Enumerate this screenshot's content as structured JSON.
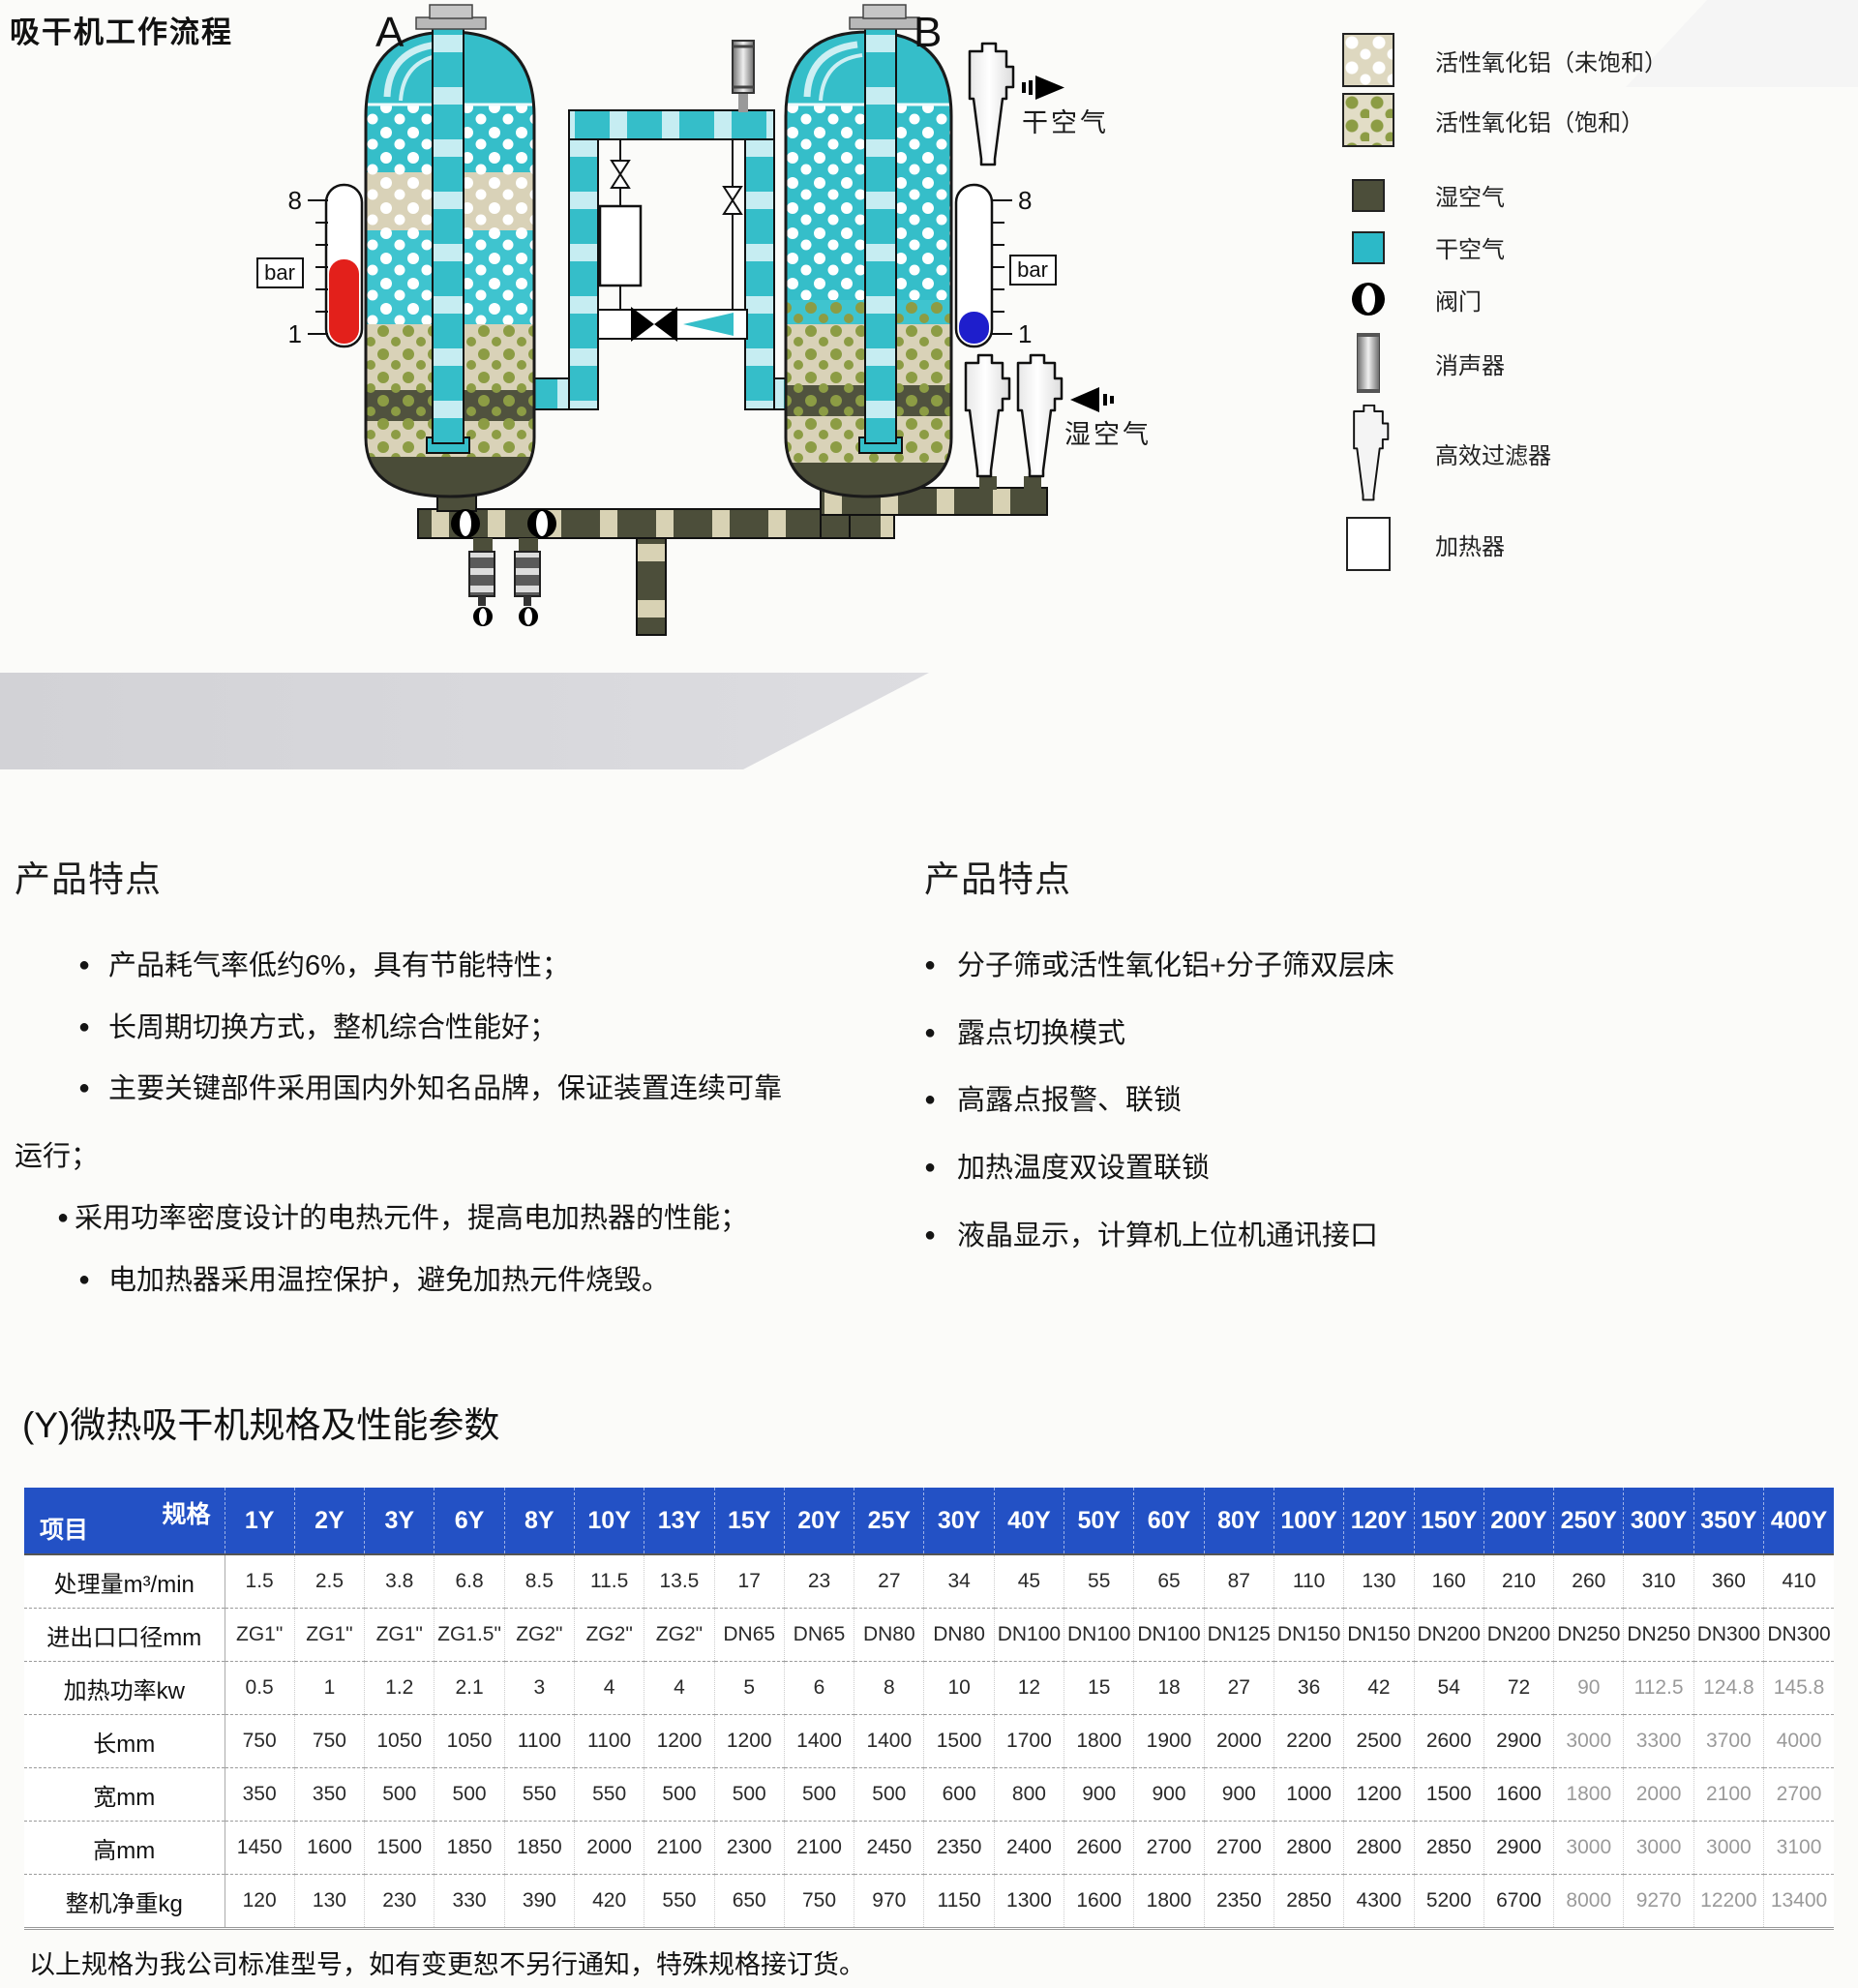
{
  "page_title": "吸干机工作流程",
  "diagram": {
    "vessel_a": "A",
    "vessel_b": "B",
    "gauge_max": "8",
    "gauge_min": "1",
    "gauge_unit": "bar",
    "dry_air": "干空气",
    "wet_air": "湿空气",
    "colors": {
      "dry_air_teal": "#35bec9",
      "pipe_stripe": "#c6edf2",
      "wet_air_dark": "#4c4e3a",
      "alumina_beige": "#d9d2b8",
      "saturated_dot": "#8c9c44",
      "gauge_high_red": "#e3201b",
      "gauge_low_blue": "#1e1ecc"
    }
  },
  "legend": {
    "items": [
      {
        "icon": "alumina-unsaturated",
        "label": "活性氧化铝（未饱和）"
      },
      {
        "icon": "alumina-saturated",
        "label": "活性氧化铝（饱和）"
      },
      {
        "icon": "wet-air-swatch",
        "label": "湿空气",
        "color": "#4c4e3a"
      },
      {
        "icon": "dry-air-swatch",
        "label": "干空气",
        "color": "#2cb9c8"
      },
      {
        "icon": "valve",
        "label": "阀门"
      },
      {
        "icon": "muffler",
        "label": "消声器"
      },
      {
        "icon": "filter",
        "label": "高效过滤器"
      },
      {
        "icon": "heater",
        "label": "加热器"
      }
    ]
  },
  "features_left": {
    "heading": "产品特点",
    "items": [
      "产品耗气率低约6%，具有节能特性；",
      "长周期切换方式，整机综合性能好；",
      "主要关键部件采用国内外知名品牌，保证装置连续可靠",
      "采用功率密度设计的电热元件，提高电加热器的性能；",
      "电加热器采用温控保护，避免加热元件烧毁。"
    ],
    "continuation": "运行；"
  },
  "features_right": {
    "heading": "产品特点",
    "items": [
      "分子筛或活性氧化铝+分子筛双层床",
      "露点切换模式",
      "高露点报警、联锁",
      "加热温度双设置联锁",
      "液晶显示，计算机上位机通讯接口"
    ]
  },
  "table": {
    "title": "(Y)微热吸干机规格及性能参数",
    "corner_top": "规格",
    "corner_bottom": "项目",
    "columns": [
      "1Y",
      "2Y",
      "3Y",
      "6Y",
      "8Y",
      "10Y",
      "13Y",
      "15Y",
      "20Y",
      "25Y",
      "30Y",
      "40Y",
      "50Y",
      "60Y",
      "80Y",
      "100Y",
      "120Y",
      "150Y",
      "200Y",
      "250Y",
      "300Y",
      "350Y",
      "400Y"
    ],
    "rows": [
      {
        "label": "处理量m³/min",
        "values": [
          "1.5",
          "2.5",
          "3.8",
          "6.8",
          "8.5",
          "11.5",
          "13.5",
          "17",
          "23",
          "27",
          "34",
          "45",
          "55",
          "65",
          "87",
          "110",
          "130",
          "160",
          "210",
          "260",
          "310",
          "360",
          "410"
        ]
      },
      {
        "label": "进出口口径mm",
        "values": [
          "ZG1\"",
          "ZG1\"",
          "ZG1\"",
          "ZG1.5\"",
          "ZG2\"",
          "ZG2\"",
          "ZG2\"",
          "DN65",
          "DN65",
          "DN80",
          "DN80",
          "DN100",
          "DN100",
          "DN100",
          "DN125",
          "DN150",
          "DN150",
          "DN200",
          "DN200",
          "DN250",
          "DN250",
          "DN300",
          "DN300"
        ]
      },
      {
        "label": "加热功率kw",
        "values": [
          "0.5",
          "1",
          "1.2",
          "2.1",
          "3",
          "4",
          "4",
          "5",
          "6",
          "8",
          "10",
          "12",
          "15",
          "18",
          "27",
          "36",
          "42",
          "54",
          "72",
          "90",
          "112.5",
          "124.8",
          "145.8"
        ]
      },
      {
        "label": "长mm",
        "values": [
          "750",
          "750",
          "1050",
          "1050",
          "1100",
          "1100",
          "1200",
          "1200",
          "1400",
          "1400",
          "1500",
          "1700",
          "1800",
          "1900",
          "2000",
          "2200",
          "2500",
          "2600",
          "2900",
          "3000",
          "3300",
          "3700",
          "4000"
        ]
      },
      {
        "label": "宽mm",
        "values": [
          "350",
          "350",
          "500",
          "500",
          "550",
          "550",
          "500",
          "500",
          "500",
          "500",
          "600",
          "800",
          "900",
          "900",
          "900",
          "1000",
          "1200",
          "1500",
          "1600",
          "1800",
          "2000",
          "2100",
          "2700"
        ]
      },
      {
        "label": "高mm",
        "values": [
          "1450",
          "1600",
          "1500",
          "1850",
          "1850",
          "2000",
          "2100",
          "2300",
          "2100",
          "2450",
          "2350",
          "2400",
          "2600",
          "2700",
          "2700",
          "2800",
          "2800",
          "2850",
          "2900",
          "3000",
          "3000",
          "3000",
          "3100"
        ]
      },
      {
        "label": "整机净重kg",
        "values": [
          "120",
          "130",
          "230",
          "330",
          "390",
          "420",
          "550",
          "650",
          "750",
          "970",
          "1150",
          "1300",
          "1600",
          "1800",
          "2350",
          "2850",
          "4300",
          "5200",
          "6700",
          "8000",
          "9270",
          "12200",
          "13400"
        ]
      }
    ],
    "footnote": "以上规格为我公司标准型号，如有变更恕不另行通知，特殊规格接订货。"
  }
}
